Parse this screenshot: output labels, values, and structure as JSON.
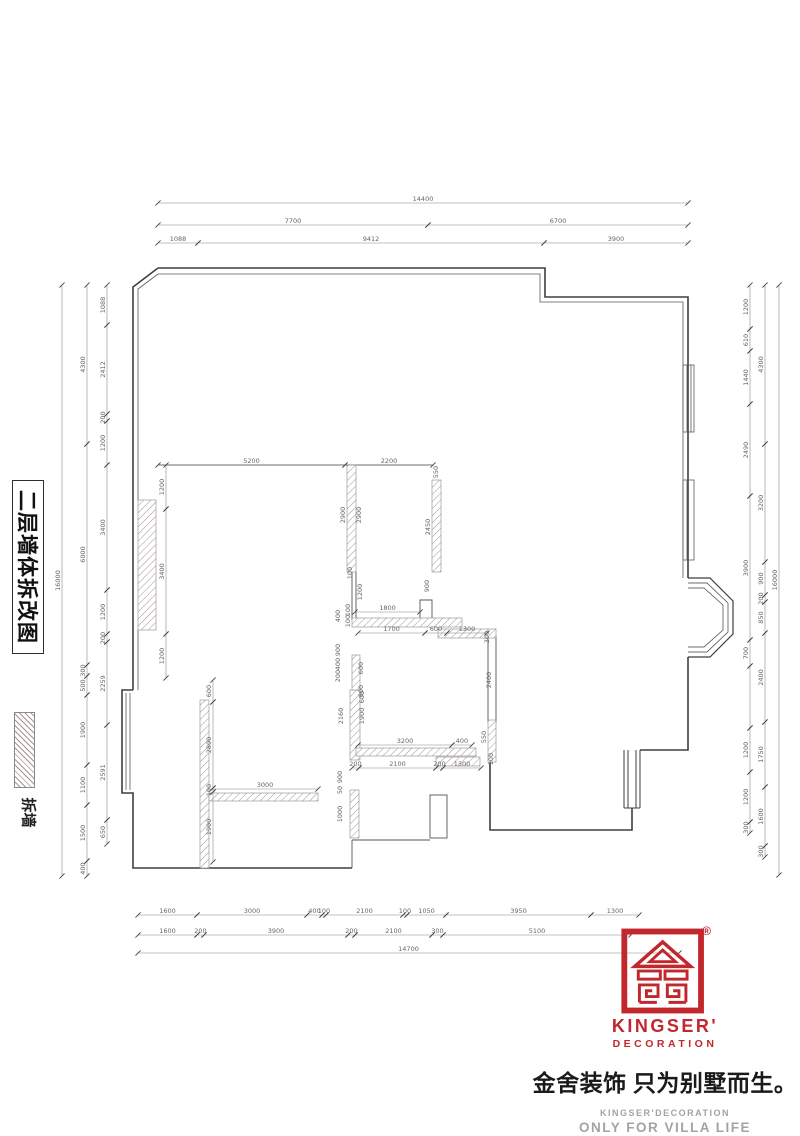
{
  "title_block": {
    "title": "二层墙体拆改图"
  },
  "legend": {
    "label": "拆墙"
  },
  "logo": {
    "brand_line1": "KINGSER'",
    "brand_line2": "DECORATION",
    "registered": "®",
    "tagline": "金舍装饰 只为别墅而生。",
    "sub_en1": "KINGSER'DECORATION",
    "sub_en2": "ONLY FOR VILLA LIFE",
    "brand_color": "#c1272d",
    "gray_color": "#a3a3a3"
  },
  "plan": {
    "line_color": "#4a4a4a",
    "dim_color": "#666666",
    "chains": [
      {
        "o": "h",
        "pos": 203,
        "segs": [
          {
            "v": "14400",
            "a": 158,
            "b": 688
          }
        ]
      },
      {
        "o": "h",
        "pos": 225,
        "segs": [
          {
            "v": "7700",
            "a": 158,
            "b": 428
          },
          {
            "v": "6700",
            "a": 428,
            "b": 688
          }
        ]
      },
      {
        "o": "h",
        "pos": 243,
        "segs": [
          {
            "v": "1088",
            "a": 158,
            "b": 198
          },
          {
            "v": "9412",
            "a": 198,
            "b": 544
          },
          {
            "v": "3900",
            "a": 544,
            "b": 688
          }
        ]
      },
      {
        "o": "h",
        "pos": 915,
        "segs": [
          {
            "v": "1600",
            "a": 138,
            "b": 197
          },
          {
            "v": "3000",
            "a": 197,
            "b": 307
          },
          {
            "v": "400",
            "a": 307,
            "b": 322
          },
          {
            "v": "100",
            "a": 322,
            "b": 326
          },
          {
            "v": "2100",
            "a": 326,
            "b": 403
          },
          {
            "v": "100",
            "a": 403,
            "b": 407
          },
          {
            "v": "1050",
            "a": 407,
            "b": 446
          },
          {
            "v": "3950",
            "a": 446,
            "b": 591
          },
          {
            "v": "1300",
            "a": 591,
            "b": 639
          }
        ]
      },
      {
        "o": "h",
        "pos": 935,
        "segs": [
          {
            "v": "1600",
            "a": 138,
            "b": 197
          },
          {
            "v": "200",
            "a": 197,
            "b": 204
          },
          {
            "v": "3900",
            "a": 204,
            "b": 348
          },
          {
            "v": "200",
            "a": 348,
            "b": 355
          },
          {
            "v": "2100",
            "a": 355,
            "b": 432
          },
          {
            "v": "300",
            "a": 432,
            "b": 443
          },
          {
            "v": "5100",
            "a": 443,
            "b": 631
          }
        ]
      },
      {
        "o": "h",
        "pos": 953,
        "segs": [
          {
            "v": "14700",
            "a": 138,
            "b": 679
          }
        ]
      },
      {
        "o": "v",
        "pos": 62,
        "segs": [
          {
            "v": "16000",
            "a": 285,
            "b": 876
          }
        ]
      },
      {
        "o": "v",
        "pos": 87,
        "segs": [
          {
            "v": "4300",
            "a": 285,
            "b": 444
          },
          {
            "v": "6000",
            "a": 444,
            "b": 665
          },
          {
            "v": "300",
            "a": 665,
            "b": 676
          },
          {
            "v": "500",
            "a": 676,
            "b": 695
          },
          {
            "v": "1900",
            "a": 695,
            "b": 765
          },
          {
            "v": "1100",
            "a": 765,
            "b": 805
          },
          {
            "v": "1500",
            "a": 805,
            "b": 861
          },
          {
            "v": "400",
            "a": 861,
            "b": 876
          }
        ]
      },
      {
        "o": "v",
        "pos": 107,
        "segs": [
          {
            "v": "1088",
            "a": 285,
            "b": 325
          },
          {
            "v": "2412",
            "a": 325,
            "b": 414
          },
          {
            "v": "200",
            "a": 414,
            "b": 421
          },
          {
            "v": "1200",
            "a": 421,
            "b": 465
          },
          {
            "v": "3400",
            "a": 465,
            "b": 590
          },
          {
            "v": "1200",
            "a": 590,
            "b": 634
          },
          {
            "v": "200",
            "a": 634,
            "b": 642
          },
          {
            "v": "2259",
            "a": 642,
            "b": 725
          },
          {
            "v": "2591",
            "a": 725,
            "b": 820
          },
          {
            "v": "650",
            "a": 820,
            "b": 844
          }
        ]
      },
      {
        "o": "v",
        "pos": 750,
        "segs": [
          {
            "v": "1200",
            "a": 285,
            "b": 329
          },
          {
            "v": "610",
            "a": 329,
            "b": 351
          },
          {
            "v": "1440",
            "a": 351,
            "b": 404
          },
          {
            "v": "2490",
            "a": 404,
            "b": 496
          },
          {
            "v": "3900",
            "a": 496,
            "b": 640
          },
          {
            "v": "700",
            "a": 640,
            "b": 666
          },
          {
            "v": "",
            "a": 666,
            "b": 728
          },
          {
            "v": "1200",
            "a": 728,
            "b": 772
          },
          {
            "v": "1200",
            "a": 772,
            "b": 822
          },
          {
            "v": "300",
            "a": 822,
            "b": 833
          }
        ]
      },
      {
        "o": "v",
        "pos": 765,
        "segs": [
          {
            "v": "4300",
            "a": 285,
            "b": 444
          },
          {
            "v": "3200",
            "a": 444,
            "b": 562
          },
          {
            "v": "900",
            "a": 562,
            "b": 595
          },
          {
            "v": "200",
            "a": 595,
            "b": 602
          },
          {
            "v": "850",
            "a": 602,
            "b": 633
          },
          {
            "v": "2400",
            "a": 633,
            "b": 722
          },
          {
            "v": "1750",
            "a": 722,
            "b": 787
          },
          {
            "v": "1600",
            "a": 787,
            "b": 846
          },
          {
            "v": "300",
            "a": 846,
            "b": 857
          }
        ]
      },
      {
        "o": "v",
        "pos": 779,
        "segs": [
          {
            "v": "16000",
            "a": 285,
            "b": 875
          }
        ]
      },
      {
        "o": "h",
        "pos": 465,
        "segs": [
          {
            "v": "5200",
            "a": 158,
            "b": 345
          },
          {
            "v": "2200",
            "a": 345,
            "b": 433
          }
        ]
      },
      {
        "o": "h",
        "pos": 612,
        "segs": [
          {
            "v": "1800",
            "a": 355,
            "b": 420
          }
        ]
      },
      {
        "o": "h",
        "pos": 633,
        "segs": [
          {
            "v": "1700",
            "a": 358,
            "b": 425
          },
          {
            "v": "600",
            "a": 425,
            "b": 447
          },
          {
            "v": "1300",
            "a": 447,
            "b": 487
          }
        ]
      },
      {
        "o": "h",
        "pos": 745,
        "segs": [
          {
            "v": "3200",
            "a": 358,
            "b": 452
          },
          {
            "v": "400",
            "a": 452,
            "b": 472
          }
        ]
      },
      {
        "o": "h",
        "pos": 768,
        "segs": [
          {
            "v": "200",
            "a": 352,
            "b": 359
          },
          {
            "v": "2100",
            "a": 359,
            "b": 436
          },
          {
            "v": "200",
            "a": 436,
            "b": 443
          },
          {
            "v": "1300",
            "a": 443,
            "b": 481
          }
        ]
      },
      {
        "o": "h",
        "pos": 789,
        "segs": [
          {
            "v": "3000",
            "a": 212,
            "b": 318
          }
        ]
      },
      {
        "o": "v",
        "pos": 166,
        "segs": [
          {
            "v": "1200",
            "a": 465,
            "b": 509
          },
          {
            "v": "3400",
            "a": 509,
            "b": 634
          },
          {
            "v": "1200",
            "a": 634,
            "b": 678
          }
        ]
      },
      {
        "o": "v",
        "pos": 213,
        "segs": [
          {
            "v": "600",
            "a": 680,
            "b": 702
          },
          {
            "v": "2800",
            "a": 702,
            "b": 788
          },
          {
            "v": "100",
            "a": 788,
            "b": 792
          },
          {
            "v": "1900",
            "a": 792,
            "b": 862
          }
        ]
      }
    ],
    "labels": [
      {
        "t": "550",
        "x": 438,
        "y": 472,
        "r": -90
      },
      {
        "t": "2900",
        "x": 345,
        "y": 515,
        "r": -90
      },
      {
        "t": "2900",
        "x": 361,
        "y": 515,
        "r": -90
      },
      {
        "t": "100",
        "x": 352,
        "y": 573,
        "r": -90
      },
      {
        "t": "1200",
        "x": 362,
        "y": 592,
        "r": -90
      },
      {
        "t": "2450",
        "x": 430,
        "y": 527,
        "r": -90
      },
      {
        "t": "900",
        "x": 429,
        "y": 586,
        "r": -90
      },
      {
        "t": "400",
        "x": 340,
        "y": 616,
        "r": -90
      },
      {
        "t": "100",
        "x": 350,
        "y": 610,
        "r": -90
      },
      {
        "t": "100",
        "x": 350,
        "y": 621,
        "r": -90
      },
      {
        "t": "300",
        "x": 489,
        "y": 637,
        "r": -90
      },
      {
        "t": "900",
        "x": 340,
        "y": 650,
        "r": -90
      },
      {
        "t": "400",
        "x": 340,
        "y": 664,
        "r": -90
      },
      {
        "t": "200",
        "x": 340,
        "y": 676,
        "r": -90
      },
      {
        "t": "600",
        "x": 363,
        "y": 668,
        "r": -90
      },
      {
        "t": "600",
        "x": 363,
        "y": 691,
        "r": -90
      },
      {
        "t": "2400",
        "x": 491,
        "y": 680,
        "r": -90
      },
      {
        "t": "2160",
        "x": 343,
        "y": 716,
        "r": -90
      },
      {
        "t": "1900",
        "x": 364,
        "y": 716,
        "r": -90
      },
      {
        "t": "600",
        "x": 364,
        "y": 697,
        "r": -90
      },
      {
        "t": "550",
        "x": 486,
        "y": 737,
        "r": -90
      },
      {
        "t": "100",
        "x": 493,
        "y": 759,
        "r": -90
      },
      {
        "t": "900",
        "x": 342,
        "y": 777,
        "r": -90
      },
      {
        "t": "50",
        "x": 342,
        "y": 790,
        "r": -90
      },
      {
        "t": "1000",
        "x": 342,
        "y": 814,
        "r": -90
      }
    ]
  }
}
